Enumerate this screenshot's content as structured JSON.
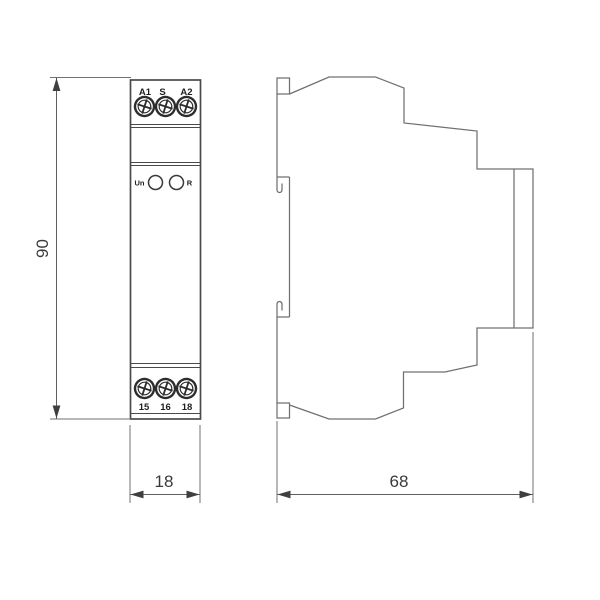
{
  "front_view": {
    "top_terminal_labels": [
      "A1",
      "S",
      "A2"
    ],
    "indicator_left_label": "Un",
    "indicator_right_label": "R",
    "bottom_terminal_labels": [
      "15",
      "16",
      "18"
    ]
  },
  "dimensions": {
    "height": "90",
    "front_width": "18",
    "side_depth": "68"
  },
  "colors": {
    "outline_dark": "#4a4a4a",
    "outline_light": "#707070",
    "dimension": "#3f3f3f",
    "background": "#ffffff"
  }
}
